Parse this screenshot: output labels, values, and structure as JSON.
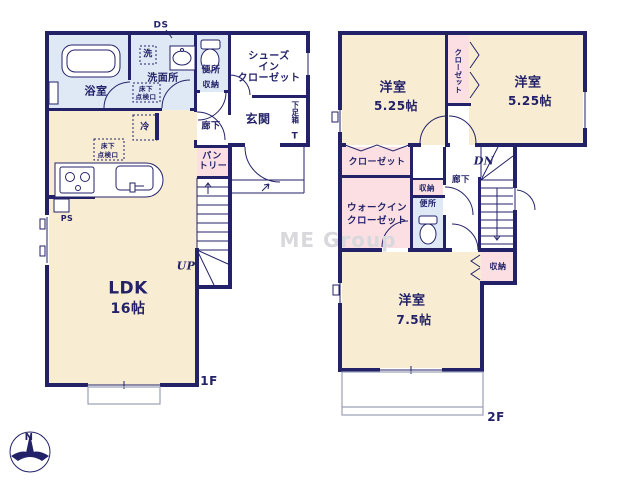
{
  "colors": {
    "wall": "#232269",
    "cream": "#f8edd3",
    "pink": "#fbdfe3",
    "blue": "#dfe9f6",
    "gray": "#99a0b5",
    "watermark": "#d9d9dd"
  },
  "watermark": "ME Group",
  "compass": {
    "north": "N"
  },
  "floor1": {
    "label": "1F",
    "ldk": "LDK",
    "ldk_size": "16帖",
    "bath": "浴室",
    "washroom": "洗面所",
    "laundry": "洗",
    "toilet": "便所",
    "toilet_storage": "収納",
    "shoes_closet_line1": "シューズ",
    "shoes_closet_line2": "イン",
    "shoes_closet_line3": "クローゼット",
    "entrance": "玄関",
    "shoe_box": "下足箱",
    "shoe_box_t": "T",
    "hallway": "廊下",
    "pantry_line1": "パン",
    "pantry_line2": "トリー",
    "fridge": "冷",
    "ps": "PS",
    "ds": "DS",
    "up": "UP",
    "hatch_line1": "床下",
    "hatch_line2": "点検口"
  },
  "floor2": {
    "label": "2F",
    "bedroom1": "洋室",
    "bedroom1_size": "5.25帖",
    "bedroom2": "洋室",
    "bedroom2_size": "5.25帖",
    "bedroom3": "洋室",
    "bedroom3_size": "7.5帖",
    "closet_vertical": "クローゼット",
    "closet": "クローゼット",
    "wic_line1": "ウォークイン",
    "wic_line2": "クローゼット",
    "storage_upper": "収納",
    "toilet": "便所",
    "hallway": "廊下",
    "storage_lower": "収納",
    "dn": "DN"
  }
}
